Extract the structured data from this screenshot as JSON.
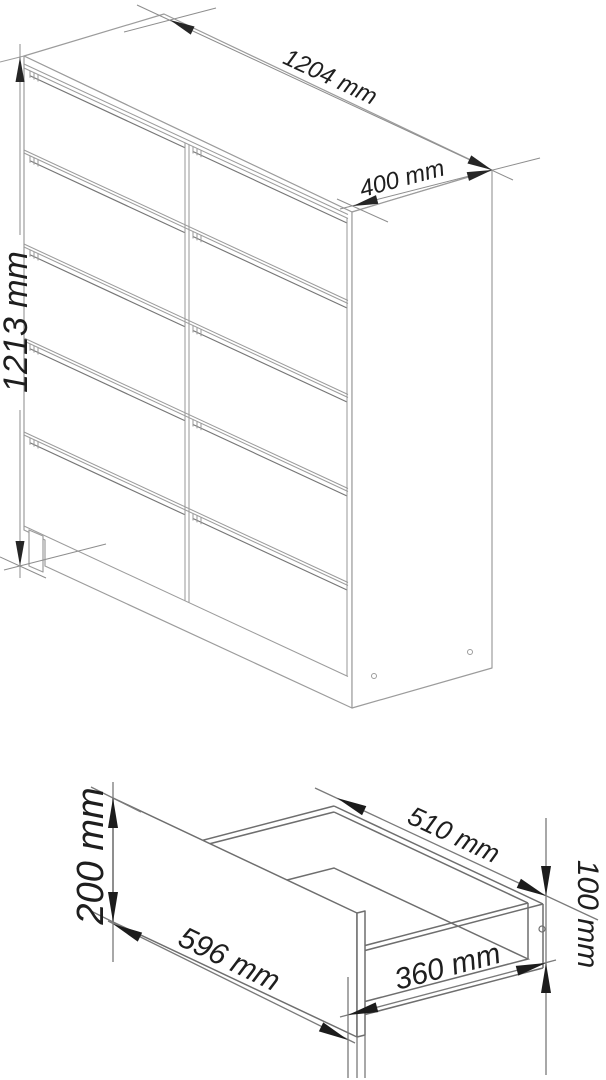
{
  "cabinet": {
    "width": "1204 mm",
    "depth": "400 mm",
    "height": "1213 mm",
    "drawer_columns": 2,
    "drawer_rows": 5
  },
  "drawer": {
    "front_width": "596 mm",
    "front_height": "200 mm",
    "inner_width": "510 mm",
    "side_depth": "360 mm",
    "side_height": "100 mm"
  }
}
